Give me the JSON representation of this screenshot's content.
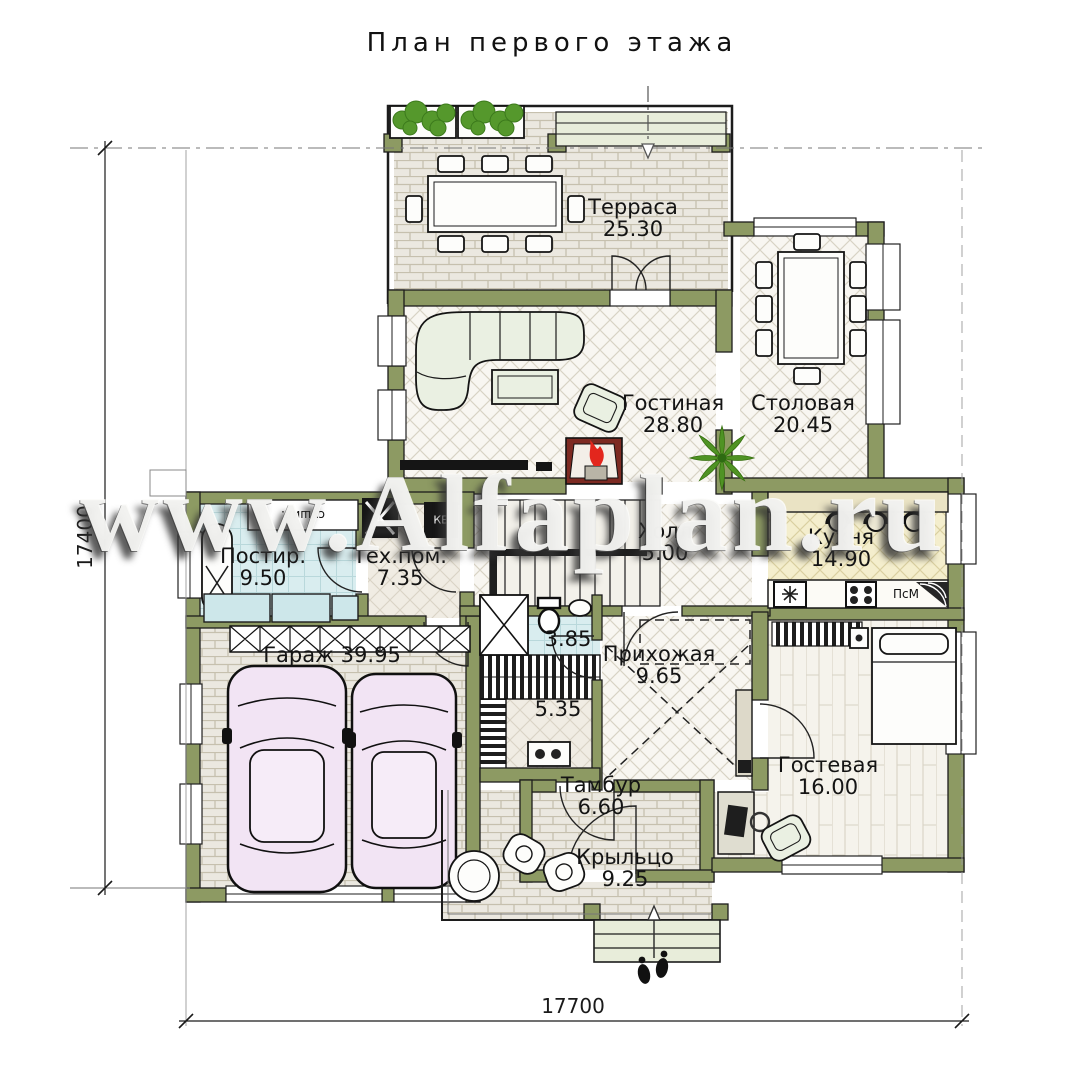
{
  "title": "План первого этажа",
  "watermark": "www.Alfaplan.ru",
  "dimensions": {
    "left_total": "17400",
    "bottom_total": "17700"
  },
  "rooms": {
    "terrace": {
      "name": "Терраса",
      "area": "25.30"
    },
    "living": {
      "name": "Гостиная",
      "area": "28.80"
    },
    "dining": {
      "name": "Столовая",
      "area": "20.45"
    },
    "kitchen": {
      "name": "Кухня",
      "area": "14.90"
    },
    "hall": {
      "name": "Холл",
      "area": "5.00"
    },
    "laundry": {
      "name": "Постир.",
      "area": "9.50"
    },
    "tech": {
      "name": "Тех.пом.",
      "area": "7.35"
    },
    "bathroom": {
      "area": "3.85"
    },
    "boiler_room": {
      "area": "5.35"
    },
    "entry_hall": {
      "name": "Прихожая",
      "area": "9.65"
    },
    "garage": {
      "name": "Гараж",
      "area": "39.95"
    },
    "vestibule": {
      "name": "Тамбур",
      "area": "6.60"
    },
    "porch": {
      "name": "Крыльцо",
      "area": "9.25"
    },
    "guest": {
      "name": "Гостевая",
      "area": "16.00"
    }
  },
  "appliances": {
    "dishwasher": "ПсМ",
    "boiler": "КБ",
    "dryer": "сушил."
  },
  "colors": {
    "wall": "#8d9a63",
    "flame": "#e3261d",
    "greenery": "#55982c",
    "car_body": "#f2e4f4"
  }
}
